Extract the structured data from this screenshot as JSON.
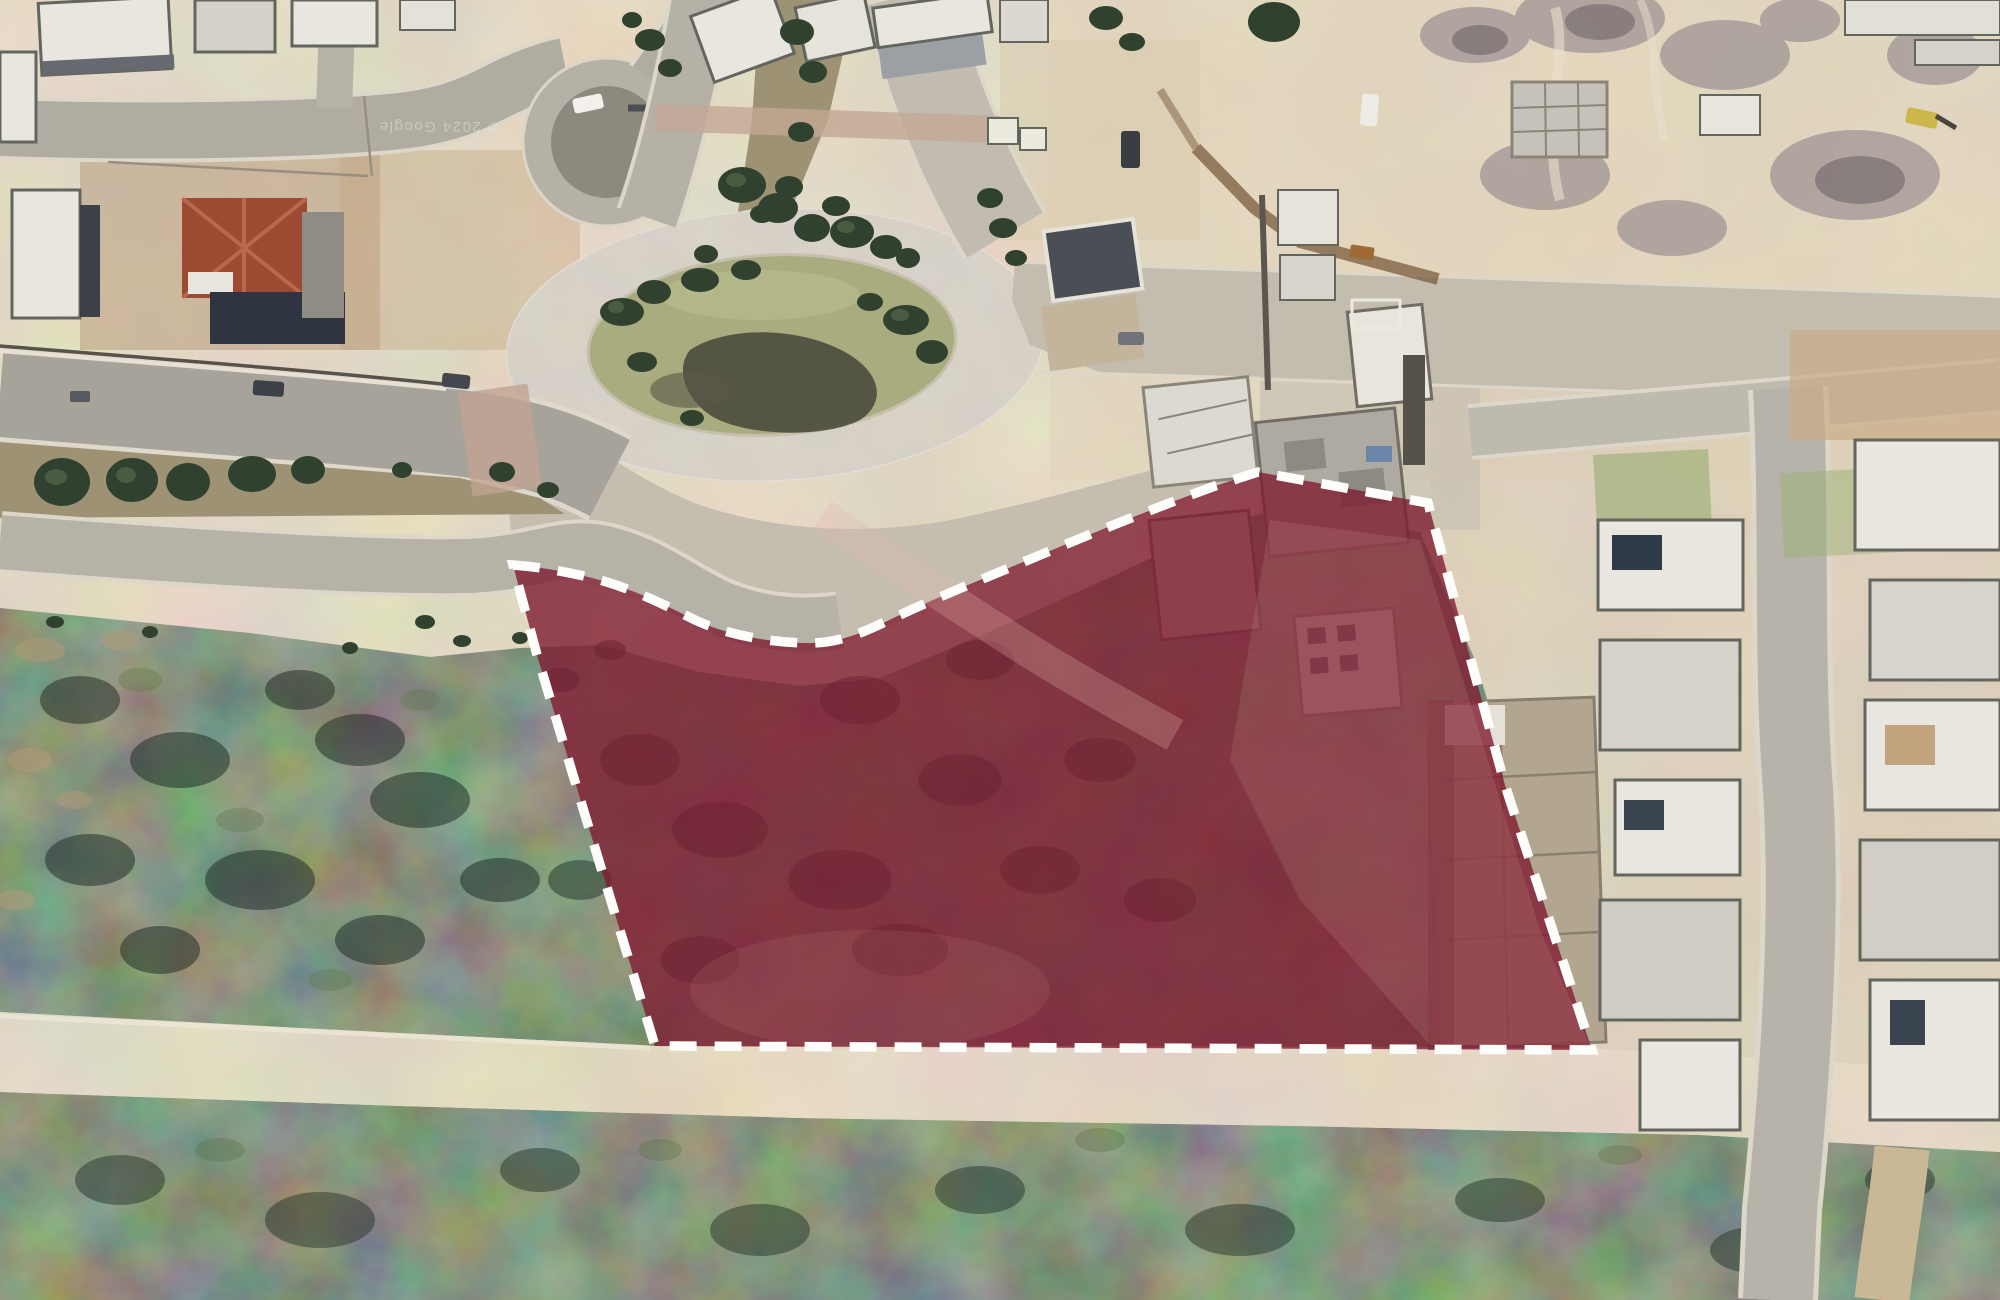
{
  "map": {
    "type": "satellite-aerial-imagery",
    "attribution": "© 2024 Google",
    "scene": "Aerial view of a hillside residential development with an oval landscaped roundabout, divided boulevards, flat-roofed houses, active construction areas and dark scrubland; a vacant land parcel south of the roundabout is highlighted with a translucent maroon fill and a white dashed boundary"
  },
  "overlay": {
    "parcel_path": "M513,565 C540,567 570,572 600,580 C635,590 665,605 695,620 C725,634 765,642 805,643 C835,644 860,634 885,622 C935,598 990,576 1045,553 C1100,530 1160,506 1215,486 L1258,472 L1428,503 L1505,785 L1592,1050 L655,1046 L585,815 L537,655 Z",
    "fill_color": "#7F1D32",
    "fill_opacity": "0.8",
    "border_color": "#FDFDFB",
    "border_style": "dashed",
    "border_dash": "27 18",
    "border_width": "9.5"
  },
  "palette": {
    "scrub_dark": "#3A4438",
    "dirt_base": "#CBBDA4",
    "bright_dirt": "#DCCEB4",
    "pavement": "#C9C2B3",
    "asphalt": "#A8A49B",
    "island_grass": "#A9AC7E",
    "roof_red": "#9C4A31",
    "building_white": "#E9E6DF",
    "building_shadow": "#5F6268",
    "track_tan": "#CFC1A5"
  }
}
